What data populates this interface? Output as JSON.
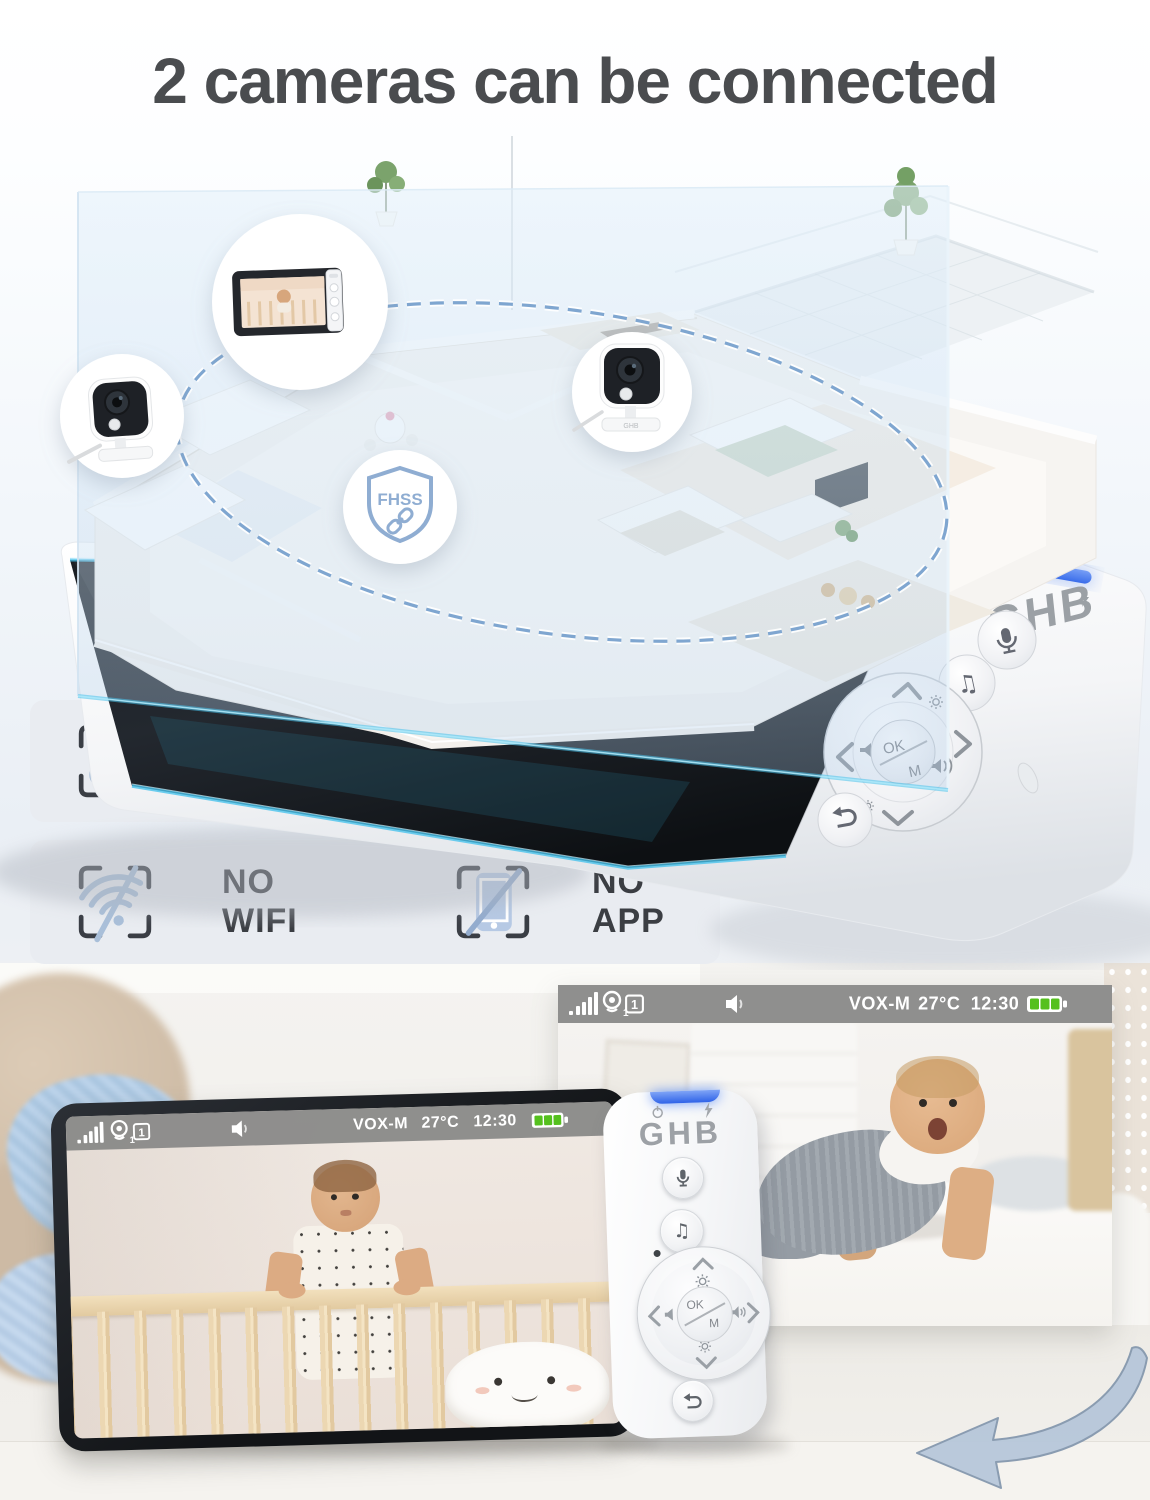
{
  "title": "2 cameras can be connected",
  "brand": {
    "logo": "GHB"
  },
  "hero": {
    "fhss_badge_label": "FHSS",
    "callouts": [
      "parent-monitor",
      "camera-left",
      "camera-right",
      "fhss-shield"
    ]
  },
  "features": {
    "fhss": {
      "label": "FHSS",
      "icon": "link-icon"
    },
    "no_wifi": {
      "label": "NO WIFI",
      "icon": "wifi-off-icon"
    },
    "no_app": {
      "label": "NO APP",
      "icon": "phone-off-icon"
    }
  },
  "status_bar": {
    "camera_count": "1",
    "channel": "1",
    "mode": "VOX-M",
    "temperature": "27°C",
    "time": "12:30",
    "icons": [
      "signal-icon",
      "camera-icon",
      "channel-badge",
      "speaker-icon",
      "battery-icon"
    ]
  },
  "controls": {
    "ok_label": "OK",
    "m_label": "M",
    "buttons": [
      "talk-button",
      "lullaby-button",
      "dpad",
      "back-button"
    ]
  },
  "colors": {
    "title_text": "#4a4c4f",
    "feature_row_bg": "#e9ecf1",
    "feature_icon_blue": "#a9bfd9",
    "status_bar_bg": "#8a8a88",
    "battery_green": "#55c01e",
    "led_blue": "#4f7df0",
    "glow_cyan": "#49c3ec"
  }
}
